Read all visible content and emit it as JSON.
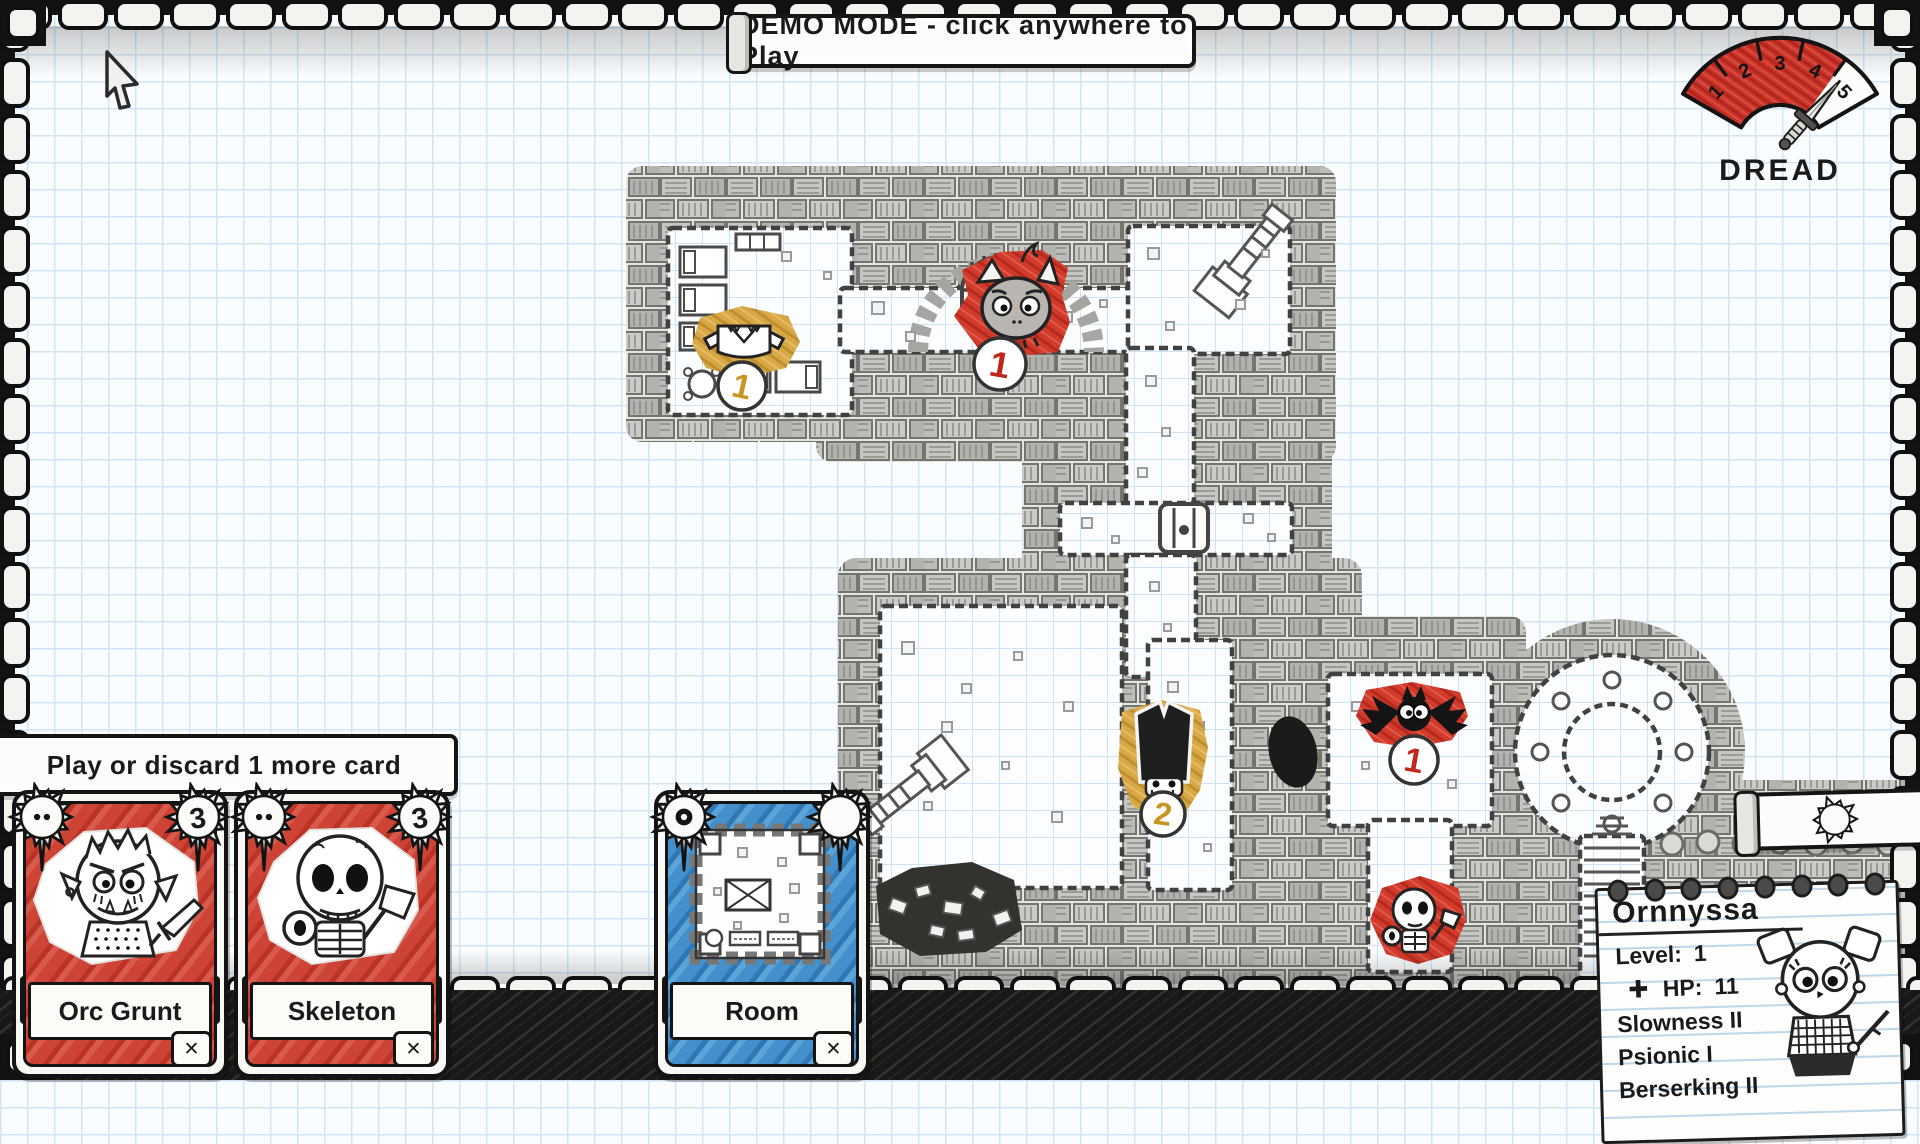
{
  "banners": {
    "demo": "DEMO MODE - click anywhere to Play",
    "hand_prompt": "Play or discard 1 more card"
  },
  "dread": {
    "label": "DREAD",
    "ticks": [
      "1",
      "2",
      "3",
      "4",
      "5"
    ],
    "filled_segments": 4,
    "max": 5
  },
  "gold_counter": {
    "value": "42"
  },
  "hand": {
    "cards": [
      {
        "name": "Orc Grunt",
        "cost": "3",
        "kind": "monster"
      },
      {
        "name": "Skeleton",
        "cost": "3",
        "kind": "monster"
      },
      {
        "name": "Room",
        "cost": "",
        "kind": "room"
      }
    ]
  },
  "map": {
    "tokens": [
      {
        "id": "loot-armor",
        "badge": "1",
        "color": "#d8a847"
      },
      {
        "id": "imp",
        "badge": "1",
        "color": "#d23a2c"
      },
      {
        "id": "dark-helm",
        "badge": "2",
        "color": "#d8a847"
      },
      {
        "id": "bat",
        "badge": "1",
        "color": "#d23a2c"
      },
      {
        "id": "skeleton",
        "badge": "",
        "color": "#d23a2c"
      }
    ]
  },
  "character": {
    "name": "Ornnyssa",
    "level_label": "Level:",
    "level": "1",
    "hp_label": "HP:",
    "hp": "11",
    "traits": [
      "Slowness II",
      "Psionic I",
      "Berserking II"
    ]
  },
  "icons": {
    "close": "✕",
    "hp_cross": "✚"
  }
}
